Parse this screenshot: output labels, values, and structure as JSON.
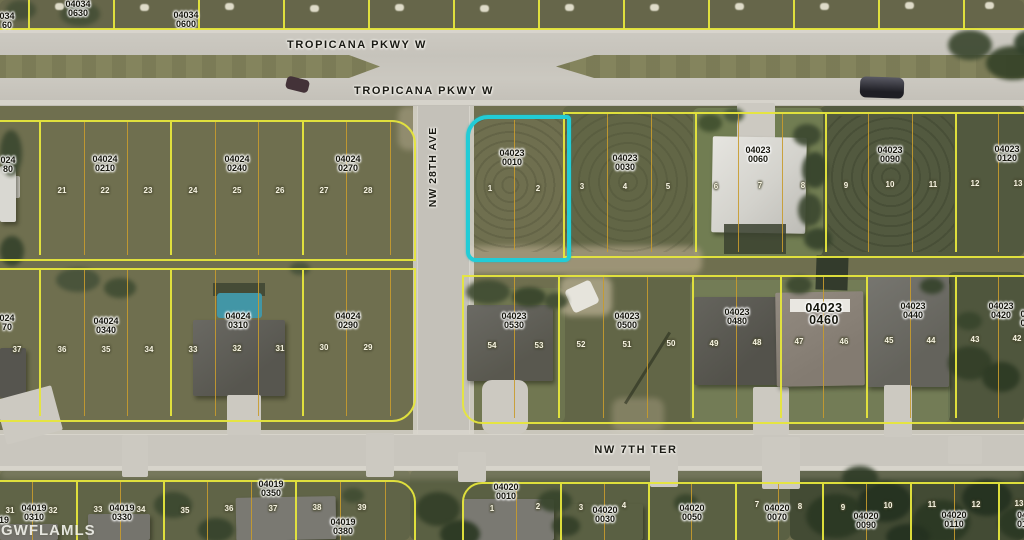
{
  "watermark": "GWFLAMLS",
  "streets": {
    "tropicana_upper": "TROPICANA PKWY W",
    "tropicana_lower": "TROPICANA PKWY W",
    "nw_28th_ave": "NW 28TH AVE",
    "nw_7th_ter": "NW 7TH TER"
  },
  "highlight": {
    "parcel": "04023 0010",
    "color": "#22ccd6"
  },
  "line_colors": {
    "parcel_boundary": "#e6e63c",
    "lot_line": "#c89b2e"
  },
  "parcel_labels": [
    {
      "l1": "04034",
      "l2": "0630",
      "x": 78,
      "y": 0
    },
    {
      "l1": "04034",
      "l2": "0600",
      "x": 186,
      "y": 11
    },
    {
      "l1": "034",
      "l2": "60",
      "x": 7,
      "y": 12
    },
    {
      "l1": "024",
      "l2": "80",
      "x": 8,
      "y": 156
    },
    {
      "l1": "04024",
      "l2": "0210",
      "x": 105,
      "y": 155
    },
    {
      "l1": "04024",
      "l2": "0240",
      "x": 237,
      "y": 155
    },
    {
      "l1": "04024",
      "l2": "0270",
      "x": 348,
      "y": 155
    },
    {
      "l1": "04023",
      "l2": "0010",
      "x": 512,
      "y": 149
    },
    {
      "l1": "04023",
      "l2": "0030",
      "x": 625,
      "y": 154
    },
    {
      "l1": "04023",
      "l2": "0060",
      "x": 758,
      "y": 146
    },
    {
      "l1": "04023",
      "l2": "0090",
      "x": 890,
      "y": 146
    },
    {
      "l1": "04023",
      "l2": "0120",
      "x": 1007,
      "y": 145
    },
    {
      "l1": "024",
      "l2": "70",
      "x": 7,
      "y": 314
    },
    {
      "l1": "04024",
      "l2": "0340",
      "x": 106,
      "y": 317
    },
    {
      "l1": "04024",
      "l2": "0310",
      "x": 238,
      "y": 312
    },
    {
      "l1": "04024",
      "l2": "0290",
      "x": 348,
      "y": 312
    },
    {
      "l1": "04023",
      "l2": "0530",
      "x": 514,
      "y": 312
    },
    {
      "l1": "04023",
      "l2": "0500",
      "x": 627,
      "y": 312
    },
    {
      "l1": "04023",
      "l2": "0480",
      "x": 737,
      "y": 308
    },
    {
      "l1": "04023",
      "l2": "0460",
      "x": 824,
      "y": 302,
      "bold": true
    },
    {
      "l1": "04023",
      "l2": "0440",
      "x": 913,
      "y": 302
    },
    {
      "l1": "04023",
      "l2": "0420",
      "x": 1001,
      "y": 302
    },
    {
      "l1": "0",
      "l2": "0",
      "x": 1023,
      "y": 310
    },
    {
      "l1": "04019",
      "l2": "0310",
      "x": 34,
      "y": 504
    },
    {
      "l1": "19",
      "l2": "",
      "x": 4,
      "y": 516
    },
    {
      "l1": "04019",
      "l2": "0330",
      "x": 122,
      "y": 504
    },
    {
      "l1": "04019",
      "l2": "0350",
      "x": 271,
      "y": 480
    },
    {
      "l1": "04019",
      "l2": "0380",
      "x": 343,
      "y": 518
    },
    {
      "l1": "04020",
      "l2": "0010",
      "x": 506,
      "y": 483
    },
    {
      "l1": "04020",
      "l2": "0030",
      "x": 605,
      "y": 506
    },
    {
      "l1": "04020",
      "l2": "0050",
      "x": 692,
      "y": 504
    },
    {
      "l1": "04020",
      "l2": "0070",
      "x": 777,
      "y": 504
    },
    {
      "l1": "04020",
      "l2": "0090",
      "x": 866,
      "y": 512
    },
    {
      "l1": "04020",
      "l2": "0110",
      "x": 954,
      "y": 511
    },
    {
      "l1": "04",
      "l2": "01",
      "x": 1022,
      "y": 511
    }
  ],
  "lot_numbers": [
    {
      "n": "21",
      "x": 62,
      "y": 186
    },
    {
      "n": "22",
      "x": 105,
      "y": 186
    },
    {
      "n": "23",
      "x": 148,
      "y": 186
    },
    {
      "n": "24",
      "x": 193,
      "y": 186
    },
    {
      "n": "25",
      "x": 237,
      "y": 186
    },
    {
      "n": "26",
      "x": 280,
      "y": 186
    },
    {
      "n": "27",
      "x": 324,
      "y": 186
    },
    {
      "n": "28",
      "x": 368,
      "y": 186
    },
    {
      "n": "1",
      "x": 490,
      "y": 184
    },
    {
      "n": "2",
      "x": 538,
      "y": 184
    },
    {
      "n": "3",
      "x": 582,
      "y": 182
    },
    {
      "n": "4",
      "x": 625,
      "y": 182
    },
    {
      "n": "5",
      "x": 668,
      "y": 182
    },
    {
      "n": "6",
      "x": 716,
      "y": 182
    },
    {
      "n": "7",
      "x": 760,
      "y": 181
    },
    {
      "n": "8",
      "x": 803,
      "y": 181
    },
    {
      "n": "9",
      "x": 846,
      "y": 181
    },
    {
      "n": "10",
      "x": 890,
      "y": 180
    },
    {
      "n": "11",
      "x": 933,
      "y": 180
    },
    {
      "n": "12",
      "x": 975,
      "y": 179
    },
    {
      "n": "13",
      "x": 1018,
      "y": 179
    },
    {
      "n": "37",
      "x": 17,
      "y": 345
    },
    {
      "n": "36",
      "x": 62,
      "y": 345
    },
    {
      "n": "35",
      "x": 106,
      "y": 345
    },
    {
      "n": "34",
      "x": 149,
      "y": 345
    },
    {
      "n": "33",
      "x": 193,
      "y": 345
    },
    {
      "n": "32",
      "x": 237,
      "y": 344
    },
    {
      "n": "31",
      "x": 280,
      "y": 344
    },
    {
      "n": "30",
      "x": 324,
      "y": 343
    },
    {
      "n": "29",
      "x": 368,
      "y": 343
    },
    {
      "n": "54",
      "x": 492,
      "y": 341
    },
    {
      "n": "53",
      "x": 539,
      "y": 341
    },
    {
      "n": "52",
      "x": 581,
      "y": 340
    },
    {
      "n": "51",
      "x": 627,
      "y": 340
    },
    {
      "n": "50",
      "x": 671,
      "y": 339
    },
    {
      "n": "49",
      "x": 714,
      "y": 339
    },
    {
      "n": "48",
      "x": 757,
      "y": 338
    },
    {
      "n": "47",
      "x": 799,
      "y": 337
    },
    {
      "n": "46",
      "x": 844,
      "y": 337
    },
    {
      "n": "45",
      "x": 889,
      "y": 336
    },
    {
      "n": "44",
      "x": 931,
      "y": 336
    },
    {
      "n": "43",
      "x": 975,
      "y": 335
    },
    {
      "n": "42",
      "x": 1017,
      "y": 334
    },
    {
      "n": "31",
      "x": 10,
      "y": 506
    },
    {
      "n": "32",
      "x": 53,
      "y": 506
    },
    {
      "n": "33",
      "x": 98,
      "y": 505
    },
    {
      "n": "34",
      "x": 141,
      "y": 505
    },
    {
      "n": "35",
      "x": 185,
      "y": 506
    },
    {
      "n": "36",
      "x": 229,
      "y": 504
    },
    {
      "n": "37",
      "x": 273,
      "y": 504
    },
    {
      "n": "38",
      "x": 317,
      "y": 503
    },
    {
      "n": "39",
      "x": 362,
      "y": 503
    },
    {
      "n": "1",
      "x": 492,
      "y": 504
    },
    {
      "n": "2",
      "x": 538,
      "y": 502
    },
    {
      "n": "3",
      "x": 581,
      "y": 503
    },
    {
      "n": "4",
      "x": 624,
      "y": 501
    },
    {
      "n": "7",
      "x": 757,
      "y": 500
    },
    {
      "n": "8",
      "x": 800,
      "y": 502
    },
    {
      "n": "9",
      "x": 843,
      "y": 503
    },
    {
      "n": "10",
      "x": 888,
      "y": 501
    },
    {
      "n": "11",
      "x": 932,
      "y": 500
    },
    {
      "n": "12",
      "x": 976,
      "y": 500
    },
    {
      "n": "13",
      "x": 1019,
      "y": 499
    }
  ]
}
